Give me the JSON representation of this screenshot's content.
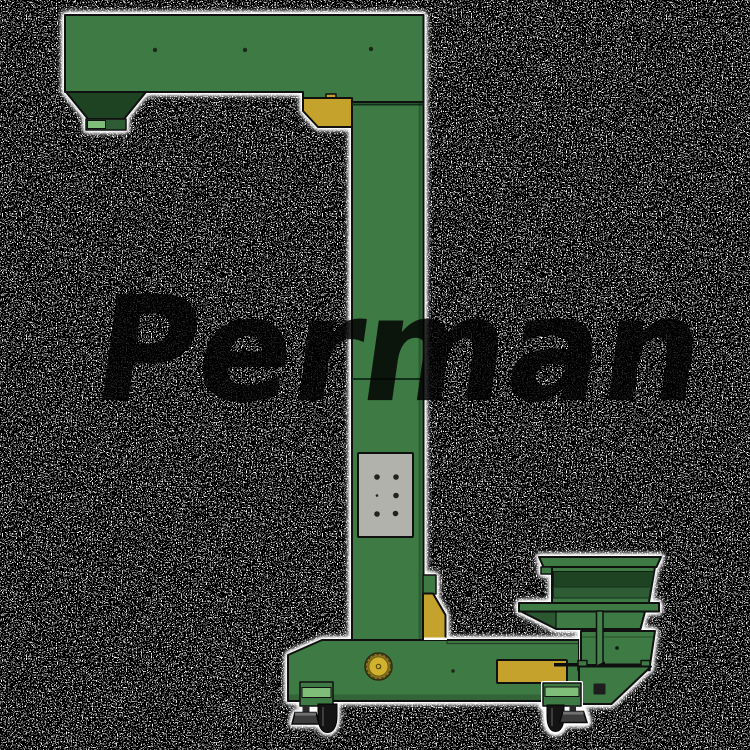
{
  "meta": {
    "description": "Product render of a green Z-type (gooseneck) bucket elevator with infeed hopper, vibratory feeder and wheeled base, shown over a dense black-and-white dissolve noise background",
    "canvas": {
      "width": 750,
      "height": 750
    }
  },
  "watermark": {
    "text": "Perman"
  },
  "colors": {
    "background": "#ffffff",
    "noise_dot": "#000000",
    "halo": "#ffffff",
    "body_green": "#3d7a44",
    "dark_green": "#1d4323",
    "mid_green": "#2e5c35",
    "light_green": "#7fbe78",
    "accent_yellow": "#c4a22c",
    "pulley_yellow": "#d2b12e",
    "panel_gray": "#b2b2ad",
    "outline": "#101010",
    "wheel_black": "#141414",
    "watermark_ink": "#2c2c2c"
  },
  "machine": {
    "name": "z-type-bucket-elevator",
    "parts": [
      {
        "id": "top-arm",
        "label": "top discharge arm"
      },
      {
        "id": "discharge-hopper",
        "label": "discharge hopper with outlet"
      },
      {
        "id": "corner-bracket-top",
        "label": "yellow top corner bracket"
      },
      {
        "id": "vertical-column",
        "label": "vertical elevator column"
      },
      {
        "id": "access-panel",
        "label": "gray access panel with six bolts"
      },
      {
        "id": "corner-bracket-bottom",
        "label": "yellow lower column bracket"
      },
      {
        "id": "base-conveyor",
        "label": "horizontal base body"
      },
      {
        "id": "drive-pulley",
        "label": "round yellow drive pulley"
      },
      {
        "id": "base-panel",
        "label": "yellow base cover panel"
      },
      {
        "id": "infeed-hopper",
        "label": "stacked infeed hopper"
      },
      {
        "id": "vibratory-feeder",
        "label": "vibratory feeder tray"
      },
      {
        "id": "caster-wheel-left",
        "label": "left caster wheel"
      },
      {
        "id": "caster-wheel-right",
        "label": "right caster wheel"
      },
      {
        "id": "leveling-foot-left",
        "label": "left leveling foot"
      },
      {
        "id": "leveling-foot-right",
        "label": "right leveling foot"
      }
    ]
  }
}
